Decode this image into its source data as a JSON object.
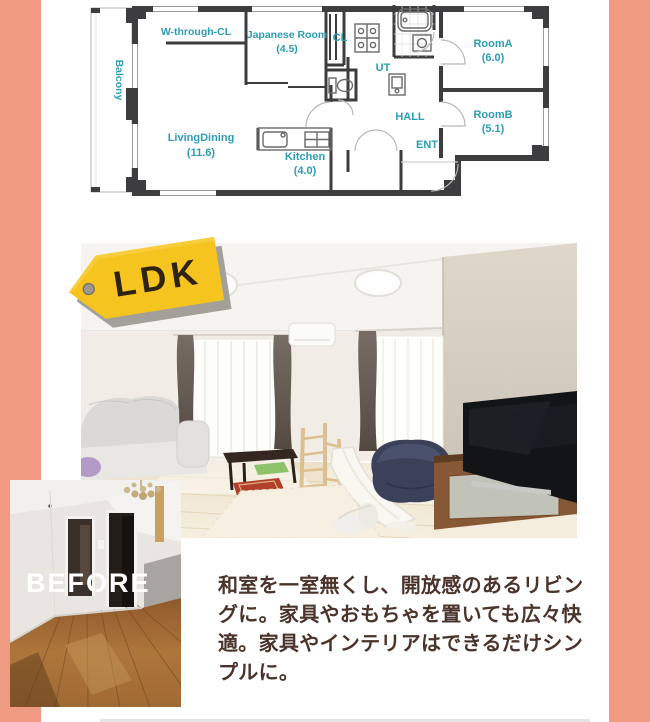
{
  "colors": {
    "page_bg": "#f19a82",
    "panel_bg": "#ffffff",
    "plan_label_teal": "#2b9db5",
    "plan_wall": "#3d3d3f",
    "tag_yellow": "#f6c41f",
    "tag_text": "#2e2310",
    "tag_shadow": "#a3a099",
    "body_text": "#4a332a",
    "before_text": "#ffffff"
  },
  "floorplan": {
    "rooms": {
      "balcony": "Balcony",
      "w_through_cl": "W-through-CL",
      "japanese_room": "Japanese Room",
      "japanese_room_size": "(4.5)",
      "cl": "CL",
      "ut": "UT",
      "room_a": "RoomA",
      "room_a_size": "(6.0)",
      "room_b": "RoomB",
      "room_b_size": "(5.1)",
      "living_dining": "LivingDining",
      "living_dining_size": "(11.6)",
      "kitchen": "Kitchen",
      "kitchen_size": "(4.0)",
      "hall": "HALL",
      "ent": "ENT"
    }
  },
  "ldk_tag": {
    "label": "LDK"
  },
  "before_label": "BEFORE",
  "description": {
    "text": "和室を一室無くし、開放感のあるリビン\nグに。家具やおもちゃを置いても広々快\n適。家具やインテリアはできるだけシン\nプルに。"
  }
}
